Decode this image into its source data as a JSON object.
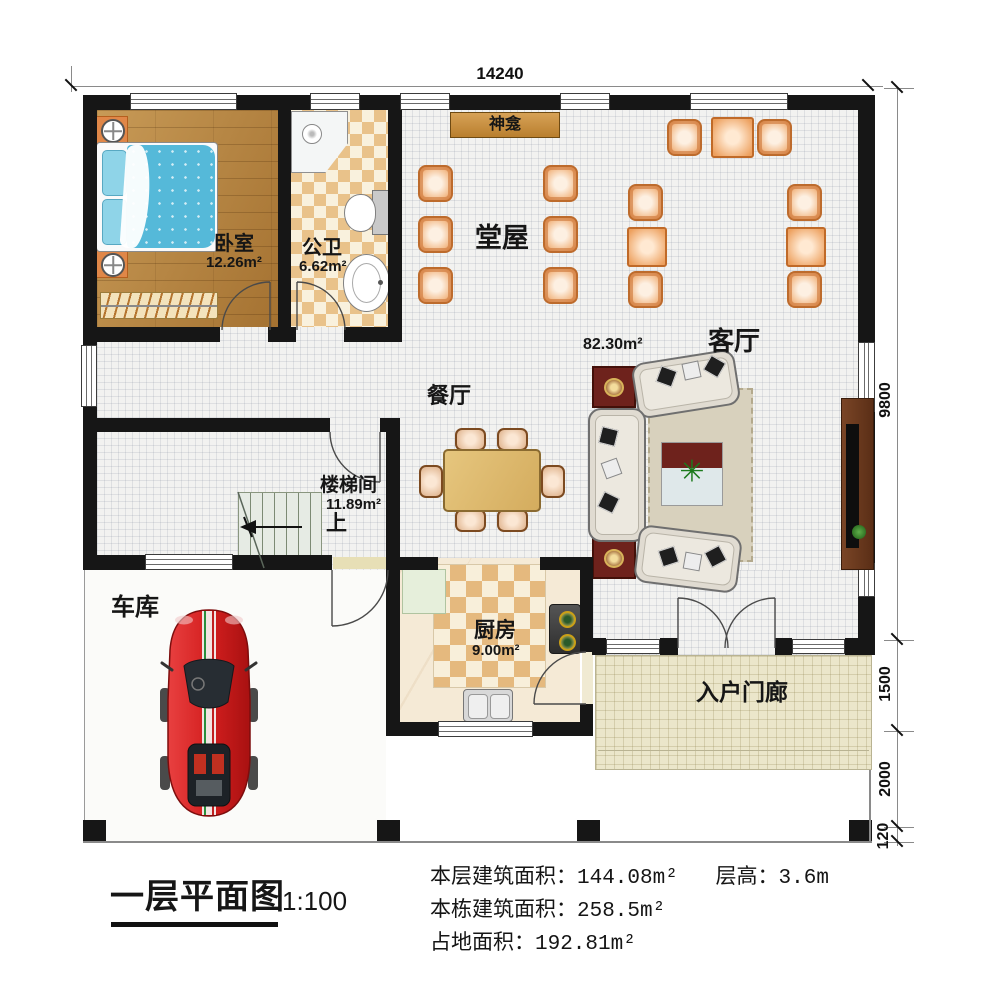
{
  "dimensions": {
    "top": "14240",
    "right": [
      "9800",
      "1500",
      "2000",
      "120"
    ]
  },
  "rooms": {
    "bedroom": {
      "name": "卧室",
      "area": "12.26m²"
    },
    "bathroom": {
      "name": "公卫",
      "area": "6.62m²"
    },
    "hall": {
      "name": "堂屋"
    },
    "shrine": {
      "name": "神龛"
    },
    "living": {
      "name": "客厅",
      "area": "82.30m²"
    },
    "dining": {
      "name": "餐厅"
    },
    "stairwell": {
      "name": "楼梯间",
      "area": "11.89m²",
      "up": "上"
    },
    "kitchen": {
      "name": "厨房",
      "area": "9.00m²"
    },
    "garage": {
      "name": "车库"
    },
    "porch": {
      "name": "入户门廊"
    }
  },
  "title_block": {
    "title": "一层平面图",
    "scale": "1:100",
    "stats": [
      {
        "label": "本层建筑面积：",
        "value": "144.08m²"
      },
      {
        "label": "层高：",
        "value": "3.6m"
      },
      {
        "label": "本栋建筑面积：",
        "value": "258.5m²"
      },
      {
        "label": "占地面积：",
        "value": "192.81m²"
      }
    ]
  },
  "colors": {
    "wall": "#161616",
    "hall_chair": "#e9965a",
    "bedroom_wood": "#b5813b",
    "tile_checker": "#e9c28a",
    "porch": "#ebe6ca",
    "shrine_banner": "#c4913e",
    "car": "#d42222"
  }
}
